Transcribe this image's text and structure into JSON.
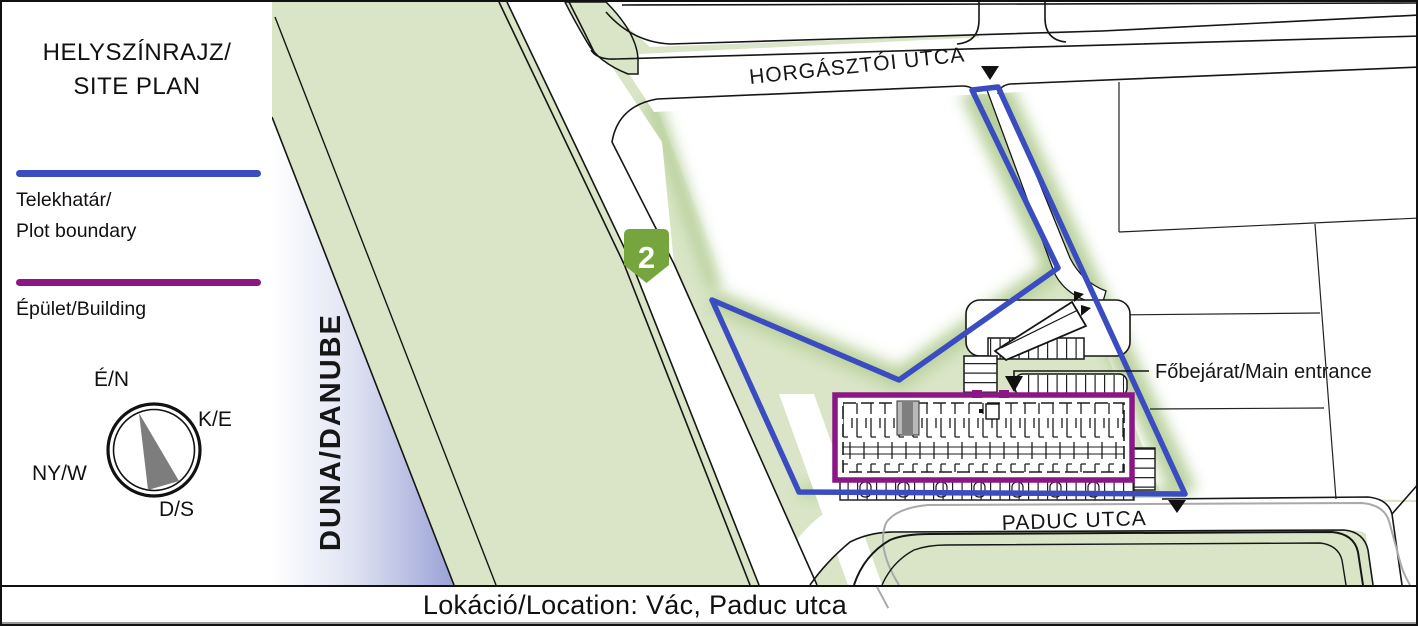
{
  "panel": {
    "title_line1": "HELYSZÍNRAJZ/",
    "title_line2": "SITE PLAN",
    "legend": {
      "plot_line1": "Telekhatár/",
      "plot_line2": "Plot boundary",
      "building_label": "Épület/Building"
    },
    "compass": {
      "north_label": "É/N",
      "east_label": "K/E",
      "west_label": "NY/W",
      "south_label": "D/S"
    }
  },
  "map": {
    "river_label": "DUNA/DANUBE",
    "route_badge": "2",
    "street_top": "HORGÁSZTÓI UTCA",
    "street_bottom": "PADUC UTCA",
    "entrance_label": "Főbejárat/Main entrance"
  },
  "footer": {
    "location_label": "Lokáció/Location: Vác, Paduc utca"
  },
  "colors": {
    "plot_boundary_blue": "#3b4cc0",
    "building_purple": "#8b1786",
    "route_badge_green": "#76a53e",
    "ground_green": "#d9e5c6",
    "glow_green": "#b5cf97",
    "river_blue": "#9aa2d6",
    "road_white": "#ffffff",
    "line_black": "#161616",
    "curb_gray": "#a9a9a9"
  }
}
